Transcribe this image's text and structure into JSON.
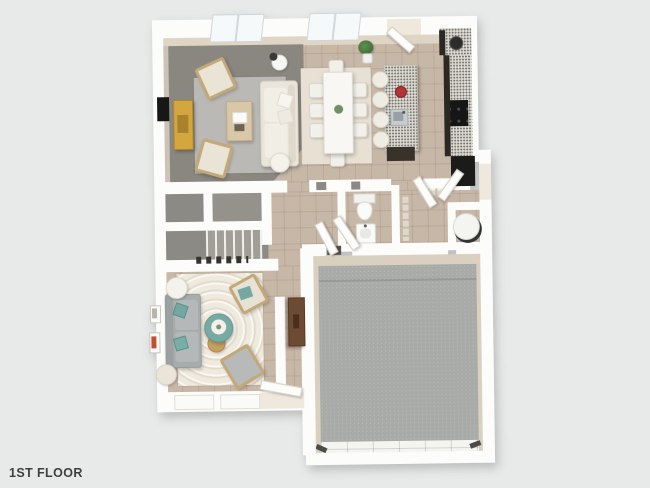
{
  "label": "1ST FLOOR",
  "palette": {
    "bg": "#e8eaea",
    "wall": "#fcfcfb",
    "wall_face": "#dfd5c5",
    "tile": "#c7b7a7",
    "floor_living": "#8a8780",
    "floor_stairs": "#8c8a84",
    "floor_garage": "#a8aba8",
    "garage_wall": "#d9d0bf",
    "rug_living": "#bab9b5",
    "rug_dining": "#e7e0d3",
    "rug_den": "#efeade",
    "speckle": "#dcdad2",
    "counter_dark": "#2b2723",
    "appliance_black": "#1b1b1a",
    "teal": "#78aaa4",
    "mustard": "#d4a63e",
    "wood": "#c79f60",
    "wood_dark": "#6d4a32",
    "red": "#b23535",
    "cream_sofa": "#e9e5da",
    "gray_sofa": "#a7acac",
    "text": "#3f3f3f"
  },
  "scene": {
    "view": "top-down-3d-floorplan",
    "rooms": [
      {
        "name": "living-room",
        "floor": "gray-carpet",
        "furniture": [
          "area-rug",
          "sectional-sofa",
          "coffee-table",
          "accent-chair",
          "accent-chair",
          "media-console",
          "wall-tv",
          "floor-lamp",
          "round-side-table"
        ]
      },
      {
        "name": "dining-area",
        "floor": "tile",
        "furniture": [
          "area-rug",
          "dining-table",
          "dining-chairs-x8",
          "centerpiece",
          "potted-plant"
        ]
      },
      {
        "name": "kitchen",
        "floor": "tile",
        "furniture": [
          "corner-counter",
          "right-counter",
          "cooktop",
          "refrigerator",
          "island",
          "island-sink",
          "fruit-bowl",
          "bar-stools-x4"
        ]
      },
      {
        "name": "stair-hall",
        "floor": "gray-carpet",
        "furniture": [
          "staircase",
          "landing",
          "under-stair-closet"
        ]
      },
      {
        "name": "powder-room",
        "floor": "tile",
        "furniture": [
          "toilet",
          "pedestal-sink"
        ]
      },
      {
        "name": "entry-mudroom",
        "floor": "tile",
        "furniture": [
          "wire-shelving",
          "water-heater"
        ]
      },
      {
        "name": "den",
        "floor": "tile",
        "furniture": [
          "area-rug",
          "sofa",
          "round-ottoman",
          "wood-side-table",
          "pouf",
          "accent-chair",
          "accent-chair",
          "wall-art-x2"
        ]
      },
      {
        "name": "rear-hallway",
        "floor": "tile",
        "furniture": [
          "console-table"
        ]
      },
      {
        "name": "garage",
        "floor": "concrete",
        "furniture": [
          "garage-door"
        ]
      }
    ],
    "doors": [
      "back-door",
      "entry-door",
      "mudroom-door",
      "powder-door",
      "garage-entry-door",
      "front-door"
    ],
    "windows": [
      "double-window-x2-top-wall",
      "den-window-x2-bottom-wall"
    ]
  }
}
